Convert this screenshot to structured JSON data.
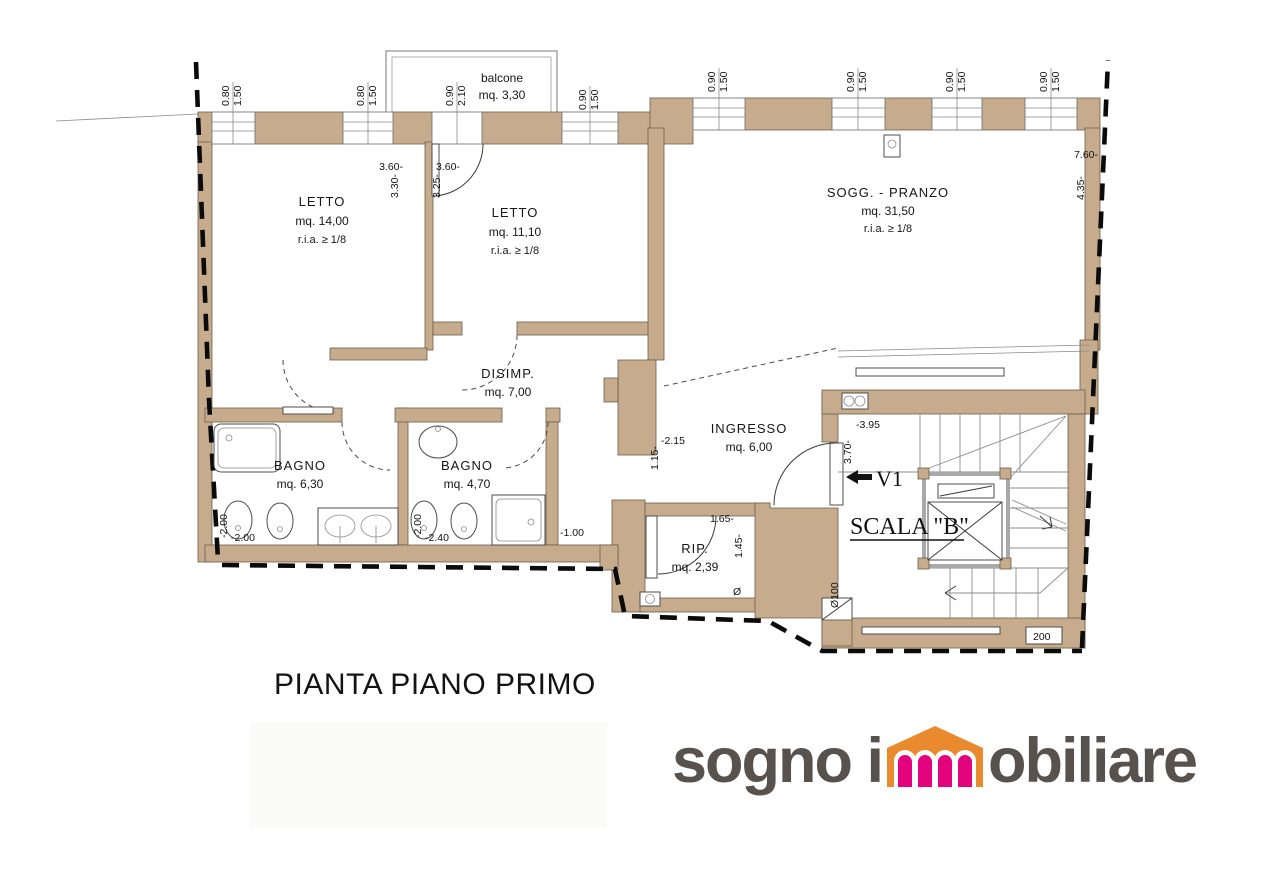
{
  "title": "PIANTA PIANO PRIMO",
  "logo": {
    "first": "sogno i",
    "second": "obiliare"
  },
  "colors": {
    "wall": "#c6ac8d",
    "logo_gray": "#57524e",
    "logo_orange": "#e98a2e",
    "logo_pink": "#e2037d"
  },
  "plan": {
    "rooms": {
      "balcone": {
        "name": "balcone",
        "area": "mq. 3,30"
      },
      "letto1": {
        "name": "LETTO",
        "area": "mq. 14,00",
        "ria": "r.i.a. ≥ 1/8"
      },
      "letto2": {
        "name": "LETTO",
        "area": "mq. 11,10",
        "ria": "r.i.a. ≥ 1/8"
      },
      "soggiorno": {
        "name": "SOGG. - PRANZO",
        "area": "mq. 31,50",
        "ria": "r.i.a. ≥ 1/8"
      },
      "disimpegno": {
        "name": "DISIMP.",
        "area": "mq. 7,00"
      },
      "bagno1": {
        "name": "BAGNO",
        "area": "mq. 6,30"
      },
      "bagno2": {
        "name": "BAGNO",
        "area": "mq. 4,70"
      },
      "ingresso": {
        "name": "INGRESSO",
        "area": "mq. 6,00"
      },
      "ripostiglio": {
        "name": "RIP.",
        "area": "mq. 2,39"
      },
      "scala": {
        "name": "SCALA \"B\"",
        "v1": "V1"
      }
    },
    "dims": {
      "win1": {
        "a": "0.80",
        "b": "1.50"
      },
      "win2": {
        "a": "0.80",
        "b": "1.50"
      },
      "balcdoor": {
        "a": "0.90",
        "b": "2.10"
      },
      "win4": {
        "a": "0.90",
        "b": "1.50"
      },
      "win5": {
        "a": "0.90",
        "b": "1.50"
      },
      "win6": {
        "a": "0.90",
        "b": "1.50"
      },
      "win7": {
        "a": "0.90",
        "b": "1.50"
      },
      "win8": {
        "a": "0.90",
        "b": "1.50"
      },
      "letto1": {
        "a": "3.60-",
        "b": "3.30-"
      },
      "letto2": {
        "a": "3.60-",
        "b": "3.25-"
      },
      "sogg": {
        "a": "7.60-",
        "b": "4.35-"
      },
      "ingr": {
        "a": "1.15-",
        "b": "-2.15"
      },
      "scala": {
        "a": "3.70-",
        "b": "-3.95"
      },
      "bagno1": {
        "a": "-2.00",
        "b": "-2.00"
      },
      "bagno2": {
        "a": "-2.00",
        "b": "-2.40"
      },
      "corr": {
        "a": "-1.00"
      },
      "rip": {
        "a": "1.65-",
        "b": "1.45-"
      },
      "rip_drain": "Ø",
      "scala_pipe": "Ø100",
      "scala_box": "200"
    }
  }
}
